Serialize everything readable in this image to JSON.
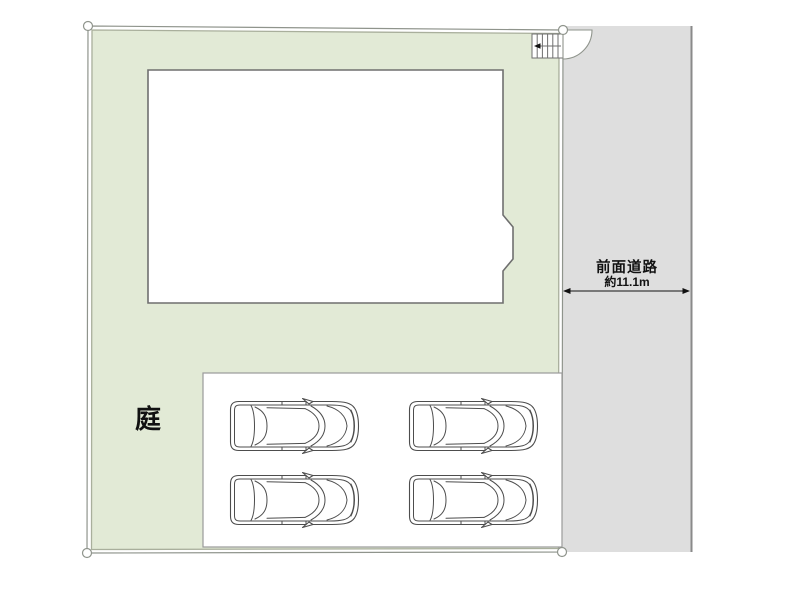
{
  "plan": {
    "garden": {
      "label": "庭"
    },
    "road": {
      "name": "前面道路",
      "width": "約11.1m"
    },
    "parking": {
      "car_count": 4
    },
    "colors": {
      "plot": "#e2ead6",
      "plot_line": "#a9af9c",
      "boundary": "#8f948c",
      "road": "#dedede",
      "road_edge": "#8a8a8a",
      "building_line": "#6f6f6f",
      "parking_line": "#9a9a9a",
      "car_line": "#4d4d4d",
      "text": "#111111"
    }
  }
}
